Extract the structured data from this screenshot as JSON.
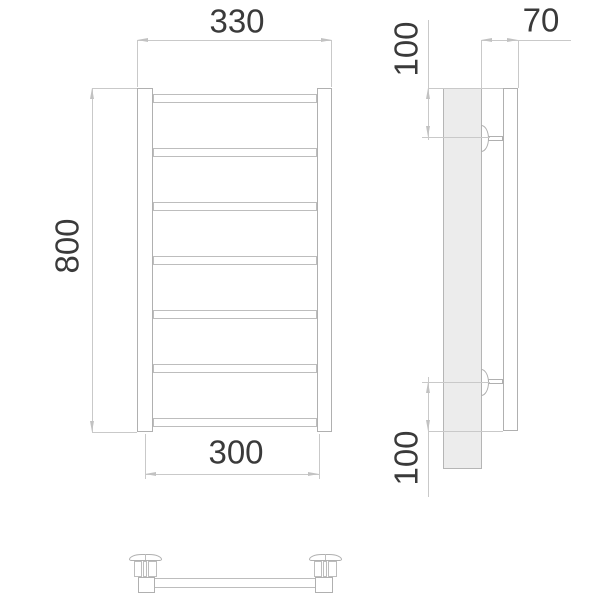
{
  "drawing": {
    "dimensions": {
      "overall_width": "330",
      "overall_height": "800",
      "rail_length": "300",
      "depth": "70",
      "top_bracket_offset": "100",
      "bottom_bracket_offset": "100"
    },
    "colors": {
      "object_line": "#b0b0b0",
      "dimension_line": "#c9c9c9",
      "profile_fill": "#ececec",
      "text": "#3a3a3a",
      "background": "#ffffff"
    }
  }
}
